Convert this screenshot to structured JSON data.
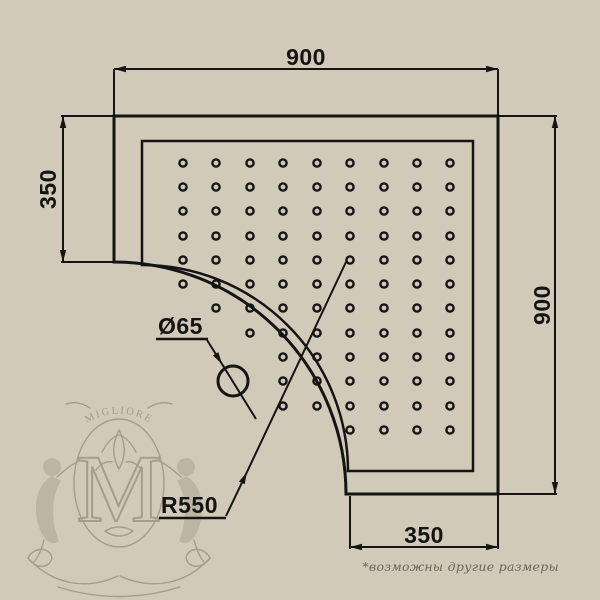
{
  "colors": {
    "background": "#d1cab9",
    "line": "#141414",
    "watermark": "#9a9181",
    "note": "#6b675e"
  },
  "dimensions": {
    "top_width": "900",
    "right_height": "900",
    "left_offset": "350",
    "bottom_offset": "350",
    "drain_diameter": "Ø65",
    "corner_radius": "R550"
  },
  "watermark": {
    "brand": "MIGLIORE",
    "monogram": "M"
  },
  "footnote": "*возможны другие размеры",
  "dots": {
    "radius": 3.6,
    "cols": [
      183,
      216,
      250,
      283,
      317,
      350,
      384,
      417,
      450
    ],
    "rows": [
      163,
      187,
      211,
      236,
      260,
      284,
      308,
      333,
      357,
      381,
      406,
      430
    ],
    "present": [
      [
        1,
        1,
        1,
        1,
        1,
        1,
        1,
        1,
        1
      ],
      [
        1,
        1,
        1,
        1,
        1,
        1,
        1,
        1,
        1
      ],
      [
        1,
        1,
        1,
        1,
        1,
        1,
        1,
        1,
        1
      ],
      [
        1,
        1,
        1,
        1,
        1,
        1,
        1,
        1,
        1
      ],
      [
        1,
        1,
        1,
        1,
        1,
        1,
        1,
        1,
        1
      ],
      [
        1,
        1,
        1,
        1,
        1,
        1,
        1,
        1,
        1
      ],
      [
        0,
        1,
        1,
        1,
        1,
        1,
        1,
        1,
        1
      ],
      [
        0,
        0,
        1,
        1,
        1,
        1,
        1,
        1,
        1
      ],
      [
        0,
        0,
        0,
        1,
        1,
        1,
        1,
        1,
        1
      ],
      [
        0,
        0,
        0,
        1,
        1,
        1,
        1,
        1,
        1
      ],
      [
        0,
        0,
        0,
        1,
        1,
        1,
        1,
        1,
        1
      ],
      [
        0,
        0,
        0,
        0,
        0,
        1,
        1,
        1,
        1
      ]
    ]
  }
}
